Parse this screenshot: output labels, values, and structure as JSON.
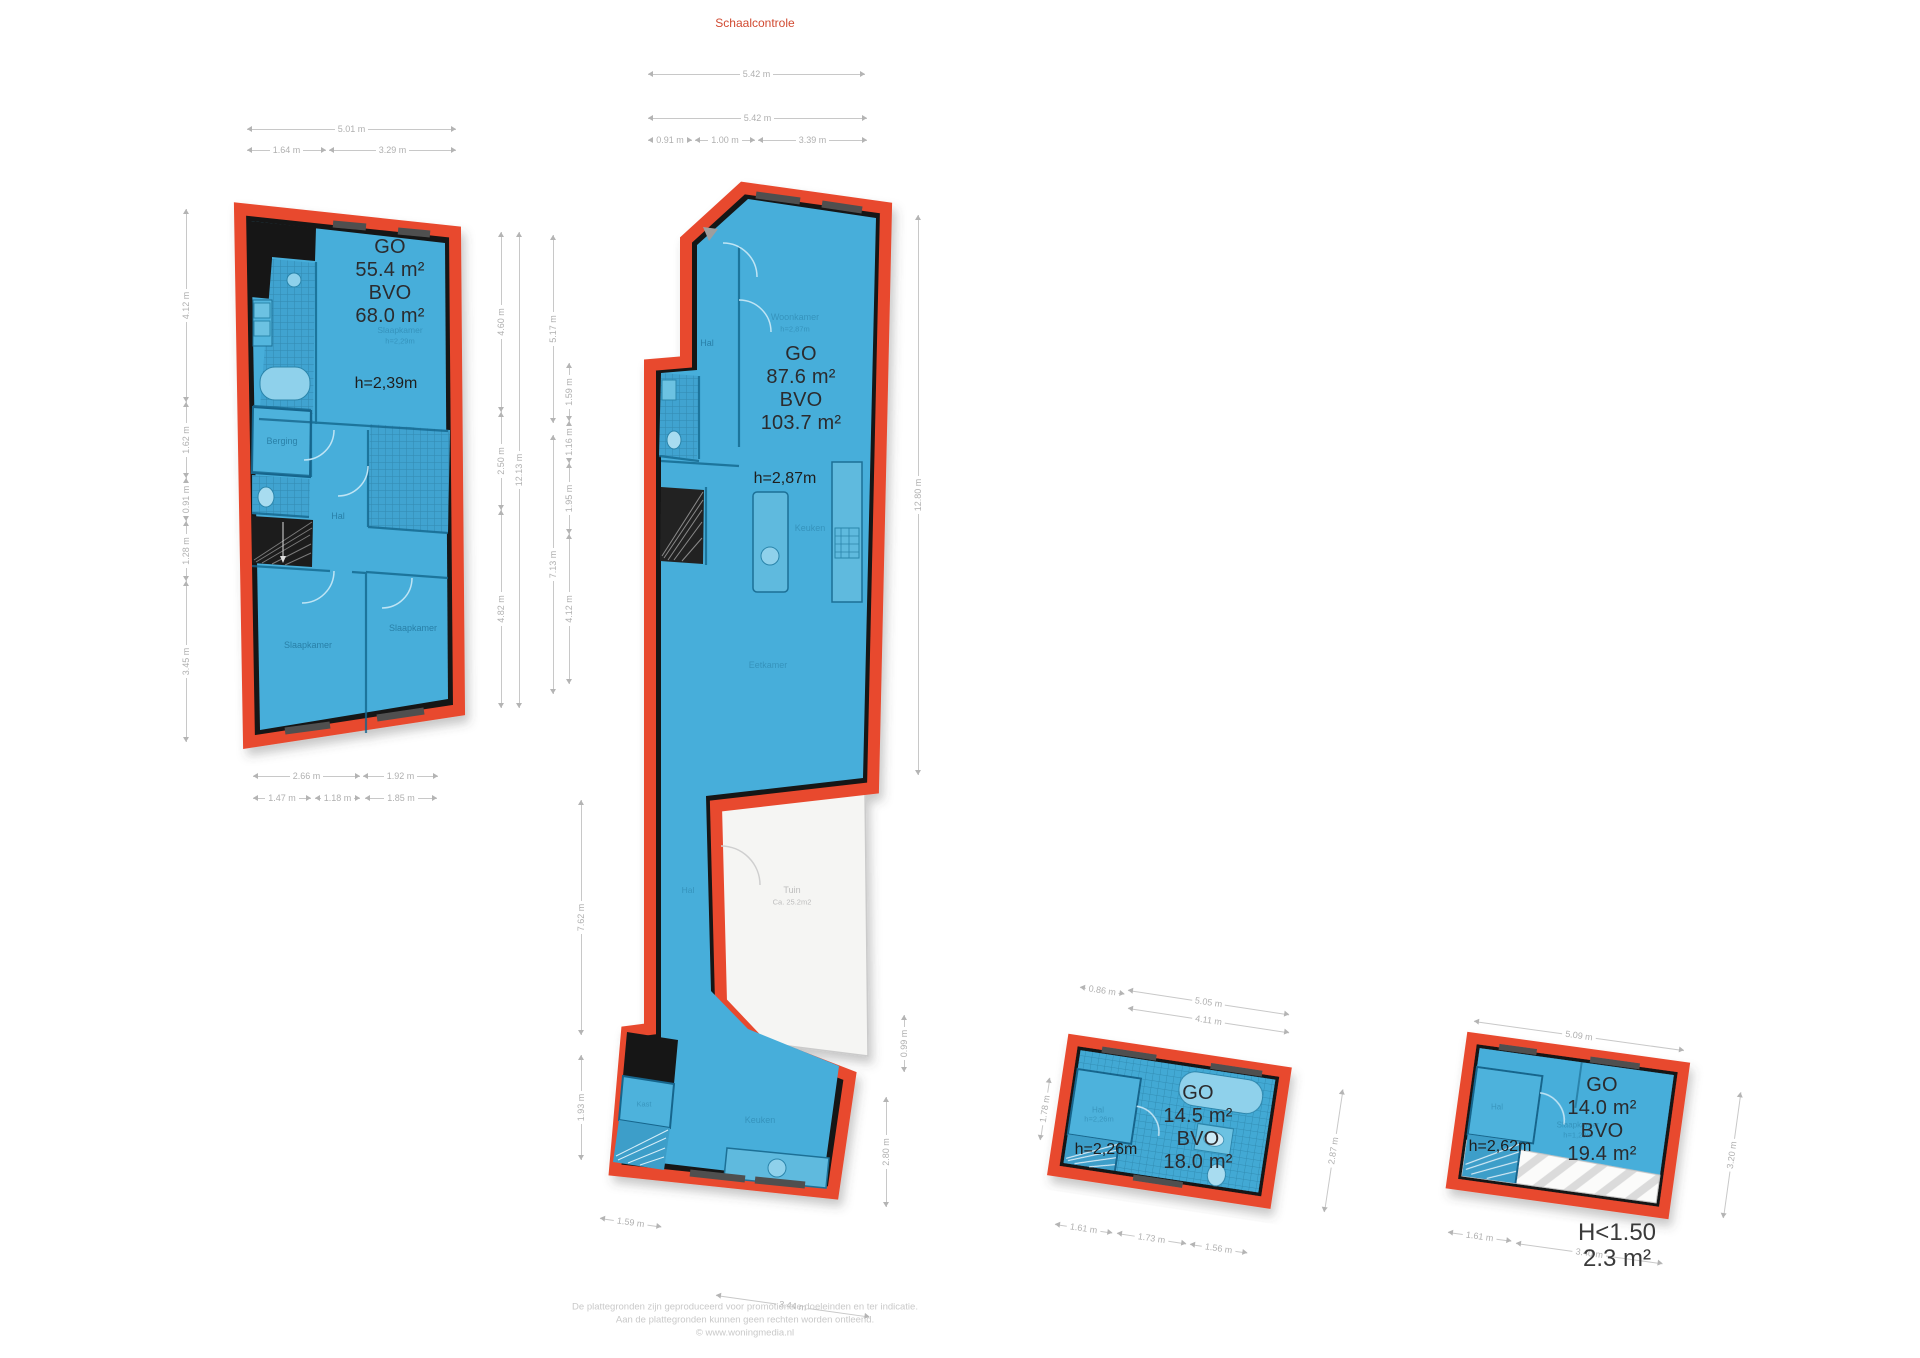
{
  "colors": {
    "floor": "#47AEDA",
    "wall": "#141414",
    "outline": "#E8492E",
    "garden": "#F5F5F3",
    "dim_text": "#B0B0B0",
    "title": "#D14A31"
  },
  "header": {
    "title": "Schaalcontrole",
    "scale_dim": "5.42 m"
  },
  "plan1": {
    "go_label": "GO",
    "go_value": "55.4 m²",
    "bvo_label": "BVO",
    "bvo_value": "68.0 m²",
    "height": "h=2,39m",
    "rooms": {
      "bedroom3": "Slaapkamer",
      "bedroom3_h": "h=2,29m",
      "berging": "Berging",
      "hal": "Hal",
      "bedroom1": "Slaapkamer",
      "bedroom2": "Slaapkamer"
    },
    "dims": {
      "top": [
        "5.01 m",
        "1.64 m",
        "3.29 m"
      ],
      "left": [
        "4.12 m",
        "1.62 m",
        "0.91 m",
        "1.28 m",
        "3.45 m"
      ],
      "right": [
        "4.60 m",
        "2.50 m",
        "4.82 m",
        "12.13 m"
      ],
      "bottom": [
        "2.66 m",
        "1.92 m",
        "1.47 m",
        "1.18 m",
        "1.85 m"
      ]
    }
  },
  "plan2": {
    "go_label": "GO",
    "go_value": "87.6 m²",
    "bvo_label": "BVO",
    "bvo_value": "103.7 m²",
    "height": "h=2,87m",
    "rooms": {
      "woonkamer": "Woonkamer",
      "woonkamer_h": "h=2,87m",
      "hal": "Hal",
      "keuken": "Keuken",
      "eetkamer": "Eetkamer",
      "hal2": "Hal",
      "tuin": "Tuin",
      "tuin_area": "Ca. 25.2m2",
      "kast": "Kast",
      "keuken2": "Keuken"
    },
    "dims": {
      "top": [
        "5.42 m",
        "0.91 m",
        "1.00 m",
        "3.39 m"
      ],
      "left": [
        "5.17 m",
        "7.13 m",
        "1.59 m",
        "1.16 m",
        "1.95 m",
        "4.12 m"
      ],
      "right": [
        "12.80 m",
        "0.99 m",
        "2.80 m"
      ],
      "lower_left": [
        "7.62 m",
        "1.93 m"
      ],
      "bottom": [
        "1.59 m",
        "3.44 m"
      ]
    }
  },
  "plan3": {
    "go_label": "GO",
    "go_value": "14.5 m²",
    "bvo_label": "BVO",
    "bvo_value": "18.0 m²",
    "height": "h=2,26m",
    "rooms": {
      "hal": "Hal",
      "hal_h": "h=2,26m"
    },
    "dims": {
      "top": [
        "0.86 m",
        "5.05 m",
        "4.11 m"
      ],
      "right": [
        "2.87 m"
      ],
      "left": [
        "1.78 m"
      ],
      "bottom": [
        "1.61 m",
        "1.73 m",
        "1.56 m"
      ]
    }
  },
  "plan4": {
    "go_label": "GO",
    "go_value": "14.0 m²",
    "bvo_label": "BVO",
    "bvo_value": "19.4 m²",
    "height": "h=2,62m",
    "low_label": "H<1.50",
    "low_value": "2.3 m²",
    "rooms": {
      "hal": "Hal",
      "slaapkamer": "Slaapkamer",
      "slaapkamer_h": "h=1,29m"
    },
    "dims": {
      "top": [
        "5.09 m"
      ],
      "right": [
        "3.20 m"
      ],
      "bottom": [
        "1.61 m",
        "3.40 m"
      ]
    }
  },
  "footer": {
    "line1": "De plattegronden zijn geproduceerd voor promotionele doeleinden en ter indicatie.",
    "line2": "Aan de plattegronden kunnen geen rechten worden ontleend.",
    "line3": "© www.woningmedia.nl"
  }
}
